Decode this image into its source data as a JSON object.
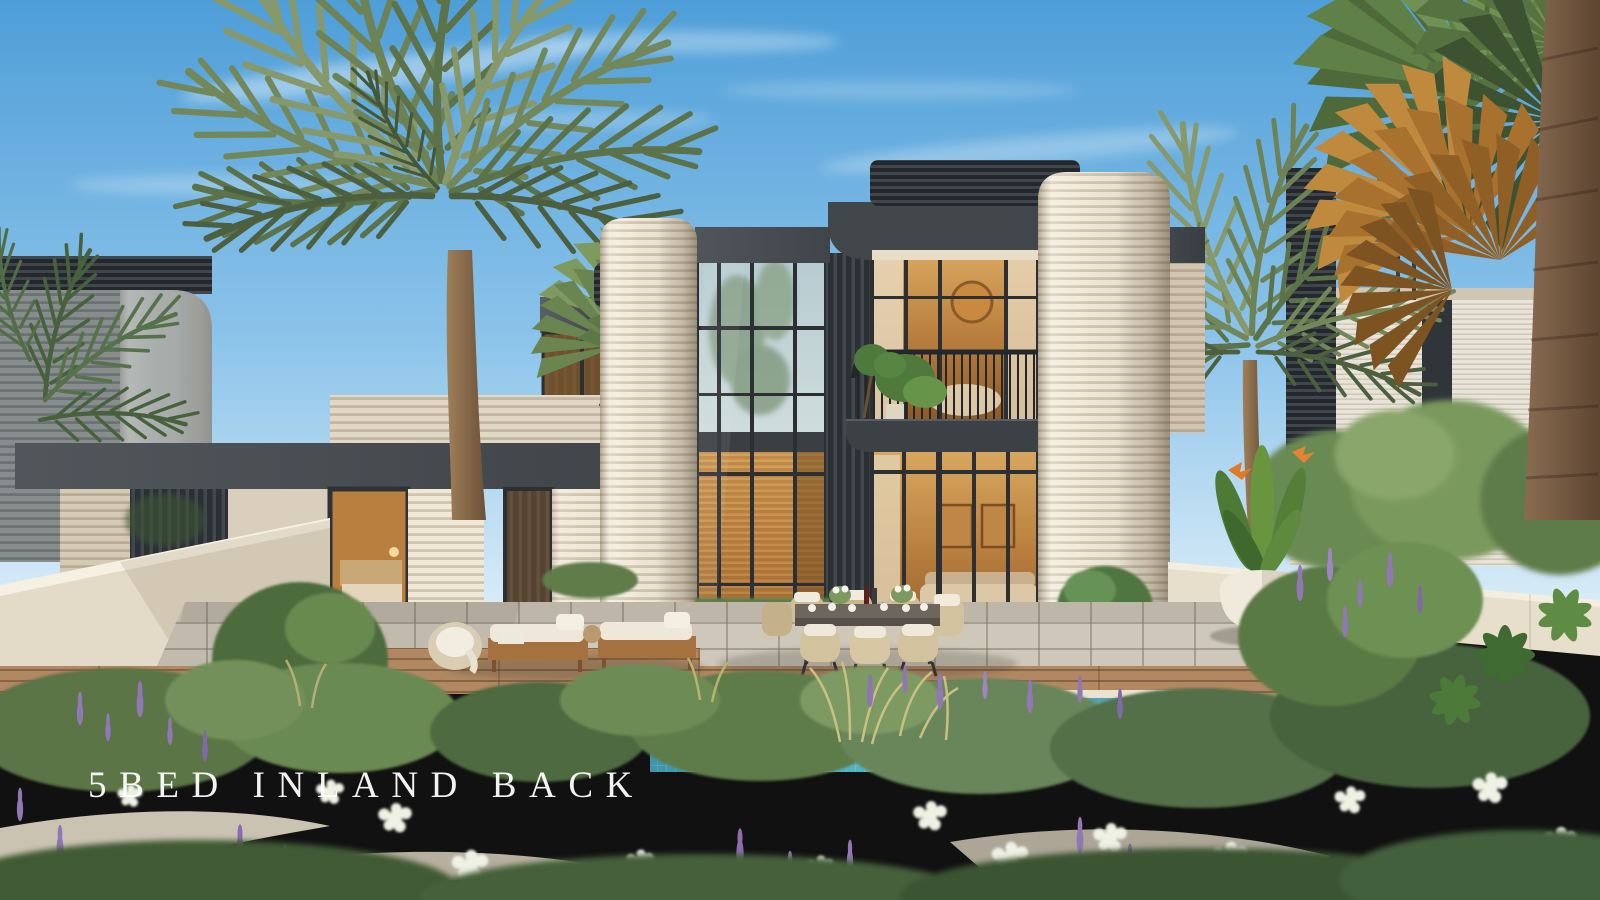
{
  "image": {
    "kind": "architectural-render-photo",
    "caption_text": "5BED INLAND BACK"
  },
  "caption": {
    "text": "5BED INLAND BACK"
  },
  "colors": {
    "sky_top": "#4e9ed8",
    "sky_mid": "#8cc4ea",
    "sky_horizon": "#ddeef8",
    "charcoal": "#474c51",
    "charcoal_dark": "#24282c",
    "cream": "#f1e9d8",
    "cream_shade": "#d7ccb7",
    "glass_warm": "#bb8140",
    "pool_deep": "#3e95ac",
    "pool_light": "#82d3df",
    "deck_wood": "#b28862",
    "paver": "#cfc8ba",
    "lawn": "#8a9a5f",
    "foliage_dark": "#43603a",
    "foliage_mid": "#6b8a52",
    "foliage_light": "#93ad6d",
    "flower_purple": "#9177b4",
    "flower_white": "#eef1e4",
    "trunk_brown": "#8a6b4e",
    "caption_text": "#ffffff"
  }
}
